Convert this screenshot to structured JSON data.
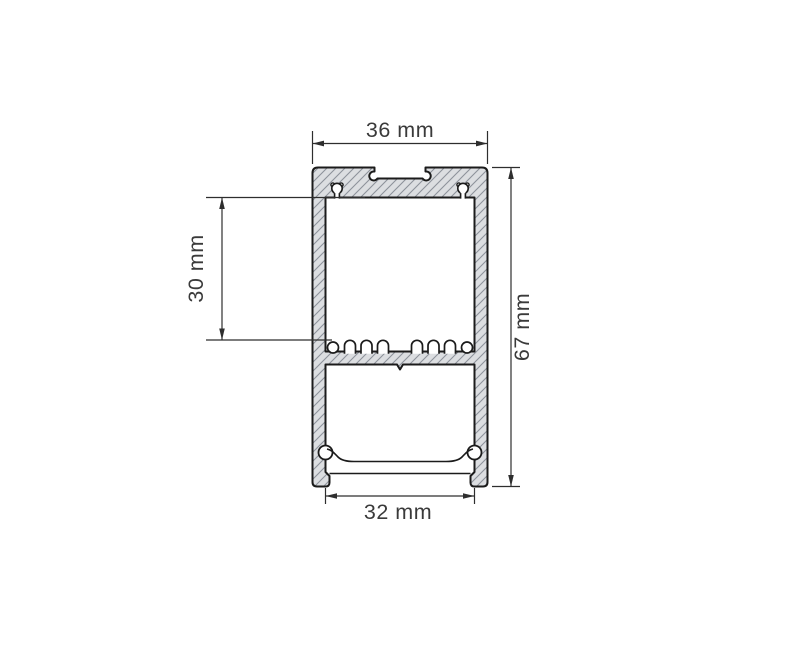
{
  "drawing": {
    "kind": "technical-cross-section",
    "dimensions": {
      "top_width": "36 mm",
      "inner_height": "30 mm",
      "total_height": "67 mm",
      "bottom_width": "32 mm"
    },
    "colors": {
      "background": "#ffffff",
      "outline": "#1b1b1b",
      "profile_fill": "#dcdee1",
      "hatch_line": "#8d929a",
      "dimension_line": "#2e2e2e",
      "dimension_text": "#3a3a3a"
    }
  }
}
